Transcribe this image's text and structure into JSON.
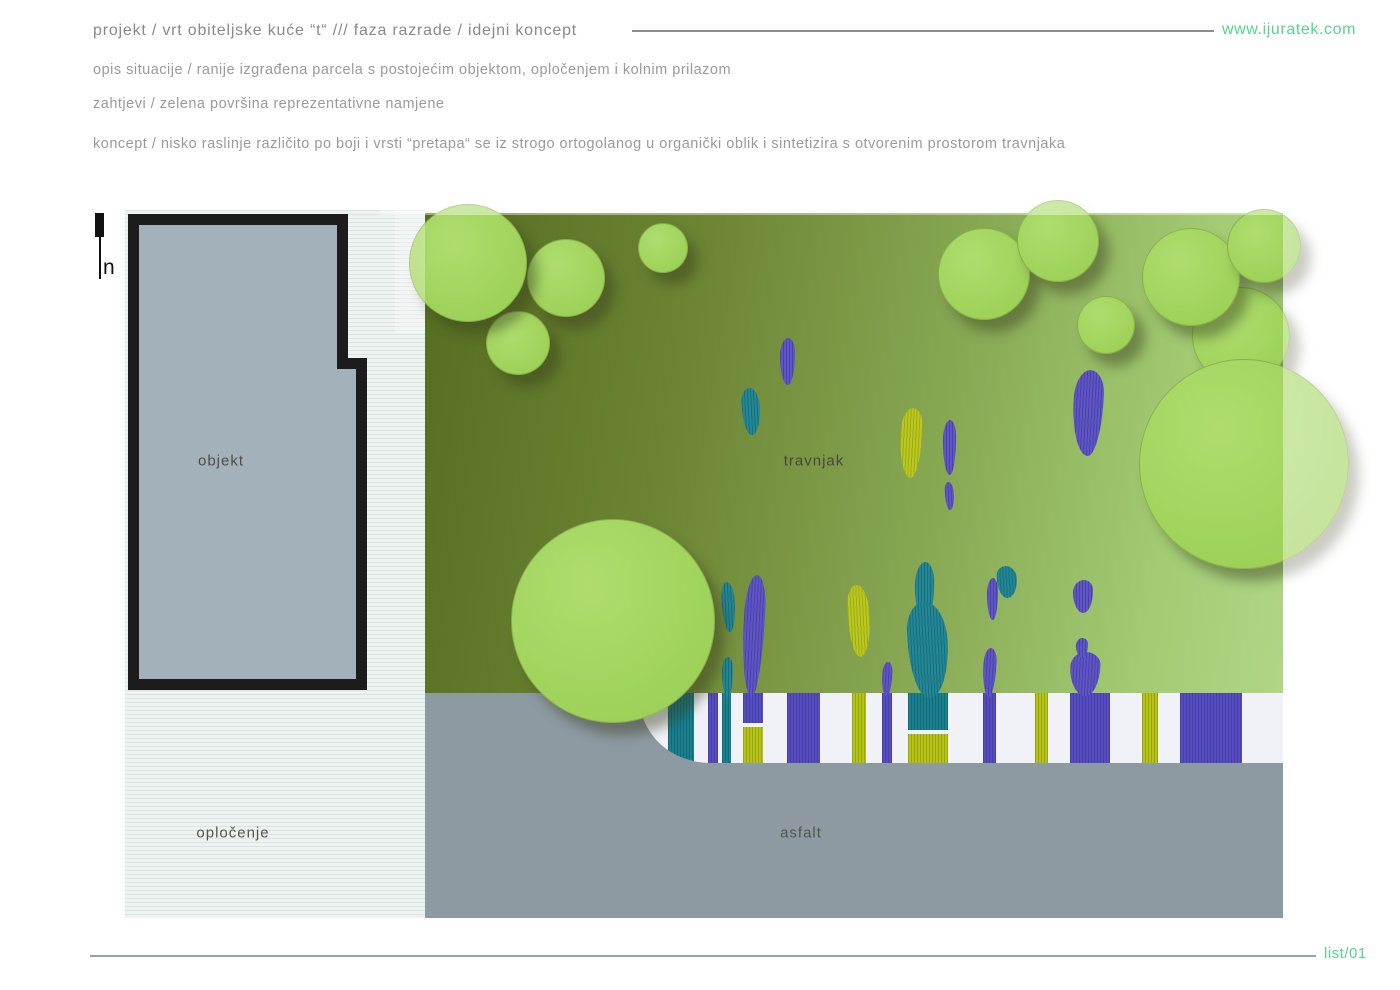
{
  "header": {
    "title": "projekt / vrt obiteljske kuće “t“  ///  faza razrade / idejni koncept",
    "website": "www.ijuratek.com",
    "lines": [
      "opis situacije / ranije izgrađena parcela s postojećim objektom, opločenjem i kolnim prilazom",
      "zahtjevi / zelena površina reprezentativne namjene",
      "koncept / nisko raslinje različito po boji i vrsti “pretapa“ se iz strogo ortogolanog u organički oblik i sintetizira s otvorenim prostorom travnjaka"
    ]
  },
  "plan": {
    "north_label": "n",
    "zones": {
      "building": "objekt",
      "lawn": "travnjak",
      "paving": "opločenje",
      "asphalt": "asfalt"
    }
  },
  "footer": {
    "sheet": "list/01"
  },
  "palette": {
    "accent_green": "#57d48d",
    "tree_green": "#a4d660",
    "lawn_dark": "#5a7124",
    "lawn_light": "#aed584",
    "purple": "#564cc2",
    "teal": "#19808f",
    "yellow": "#b5c414",
    "asphalt_gray": "#8d9aa2",
    "building_gray": "#a3b1ba",
    "band_white": "#f1f2f7",
    "paving_white": "#eef2f0",
    "outline_black": "#1c1c1c",
    "text_gray": "#9a9a9c"
  },
  "trees": [
    {
      "x": 361,
      "y": 101,
      "d": 62
    },
    {
      "x": 402,
      "y": 29,
      "d": 76
    },
    {
      "x": 284,
      "y": -6,
      "d": 116
    },
    {
      "x": 513,
      "y": 13,
      "d": 48
    },
    {
      "x": 813,
      "y": 18,
      "d": 90
    },
    {
      "x": 892,
      "y": -10,
      "d": 80
    },
    {
      "x": 952,
      "y": 86,
      "d": 56
    },
    {
      "x": 1067,
      "y": 77,
      "d": 96
    },
    {
      "x": 1017,
      "y": 18,
      "d": 96
    },
    {
      "x": 1102,
      "y": -1,
      "d": 72
    },
    {
      "x": 1014,
      "y": 149,
      "d": 208
    },
    {
      "x": 386,
      "y": 309,
      "d": 202
    }
  ],
  "plants": [
    {
      "x": 655,
      "y": 128,
      "w": 15,
      "h": 47,
      "c": "purple"
    },
    {
      "x": 617,
      "y": 178,
      "w": 18,
      "h": 47,
      "c": "teal"
    },
    {
      "x": 775,
      "y": 198,
      "w": 22,
      "h": 70,
      "c": "yellow"
    },
    {
      "x": 818,
      "y": 210,
      "w": 13,
      "h": 55,
      "c": "purple"
    },
    {
      "x": 820,
      "y": 272,
      "w": 9,
      "h": 28,
      "c": "purple"
    },
    {
      "x": 948,
      "y": 160,
      "w": 30,
      "h": 86,
      "c": "purple"
    },
    {
      "x": 948,
      "y": 370,
      "w": 20,
      "h": 33,
      "c": "purple"
    },
    {
      "x": 597,
      "y": 372,
      "w": 13,
      "h": 50,
      "c": "teal"
    },
    {
      "x": 618,
      "y": 365,
      "w": 21,
      "h": 122,
      "c": "purple"
    },
    {
      "x": 597,
      "y": 447,
      "w": 11,
      "h": 40,
      "c": "teal"
    },
    {
      "x": 723,
      "y": 375,
      "w": 22,
      "h": 72,
      "c": "yellow"
    },
    {
      "x": 757,
      "y": 452,
      "w": 10,
      "h": 35,
      "c": "purple"
    },
    {
      "x": 790,
      "y": 352,
      "w": 19,
      "h": 62,
      "c": "teal"
    },
    {
      "x": 783,
      "y": 392,
      "w": 40,
      "h": 96,
      "c": "teal"
    },
    {
      "x": 858,
      "y": 438,
      "w": 13,
      "h": 49,
      "c": "purple"
    },
    {
      "x": 862,
      "y": 368,
      "w": 11,
      "h": 42,
      "c": "purple"
    },
    {
      "x": 872,
      "y": 356,
      "w": 20,
      "h": 32,
      "c": "teal"
    },
    {
      "x": 945,
      "y": 442,
      "w": 30,
      "h": 44,
      "c": "purple"
    },
    {
      "x": 951,
      "y": 428,
      "w": 12,
      "h": 20,
      "c": "purple"
    }
  ],
  "stripes": [
    {
      "x": 28,
      "w": 26,
      "c": "teal"
    },
    {
      "x": 68,
      "w": 10,
      "c": "purple"
    },
    {
      "x": 82,
      "w": 9,
      "c": "teal"
    },
    {
      "x": 103,
      "w": 20,
      "c": "purple",
      "y": 0,
      "h": 30
    },
    {
      "x": 103,
      "w": 20,
      "c": "yellow",
      "y": 34,
      "h": 36
    },
    {
      "x": 147,
      "w": 33,
      "c": "purple"
    },
    {
      "x": 212,
      "w": 14,
      "c": "yellow"
    },
    {
      "x": 242,
      "w": 10,
      "c": "purple"
    },
    {
      "x": 268,
      "w": 40,
      "c": "teal",
      "y": 0,
      "h": 37
    },
    {
      "x": 268,
      "w": 40,
      "c": "yellow",
      "y": 41,
      "h": 29
    },
    {
      "x": 343,
      "w": 13,
      "c": "purple"
    },
    {
      "x": 395,
      "w": 13,
      "c": "yellow"
    },
    {
      "x": 430,
      "w": 40,
      "c": "purple"
    },
    {
      "x": 502,
      "w": 16,
      "c": "yellow"
    },
    {
      "x": 540,
      "w": 62,
      "c": "purple"
    }
  ]
}
